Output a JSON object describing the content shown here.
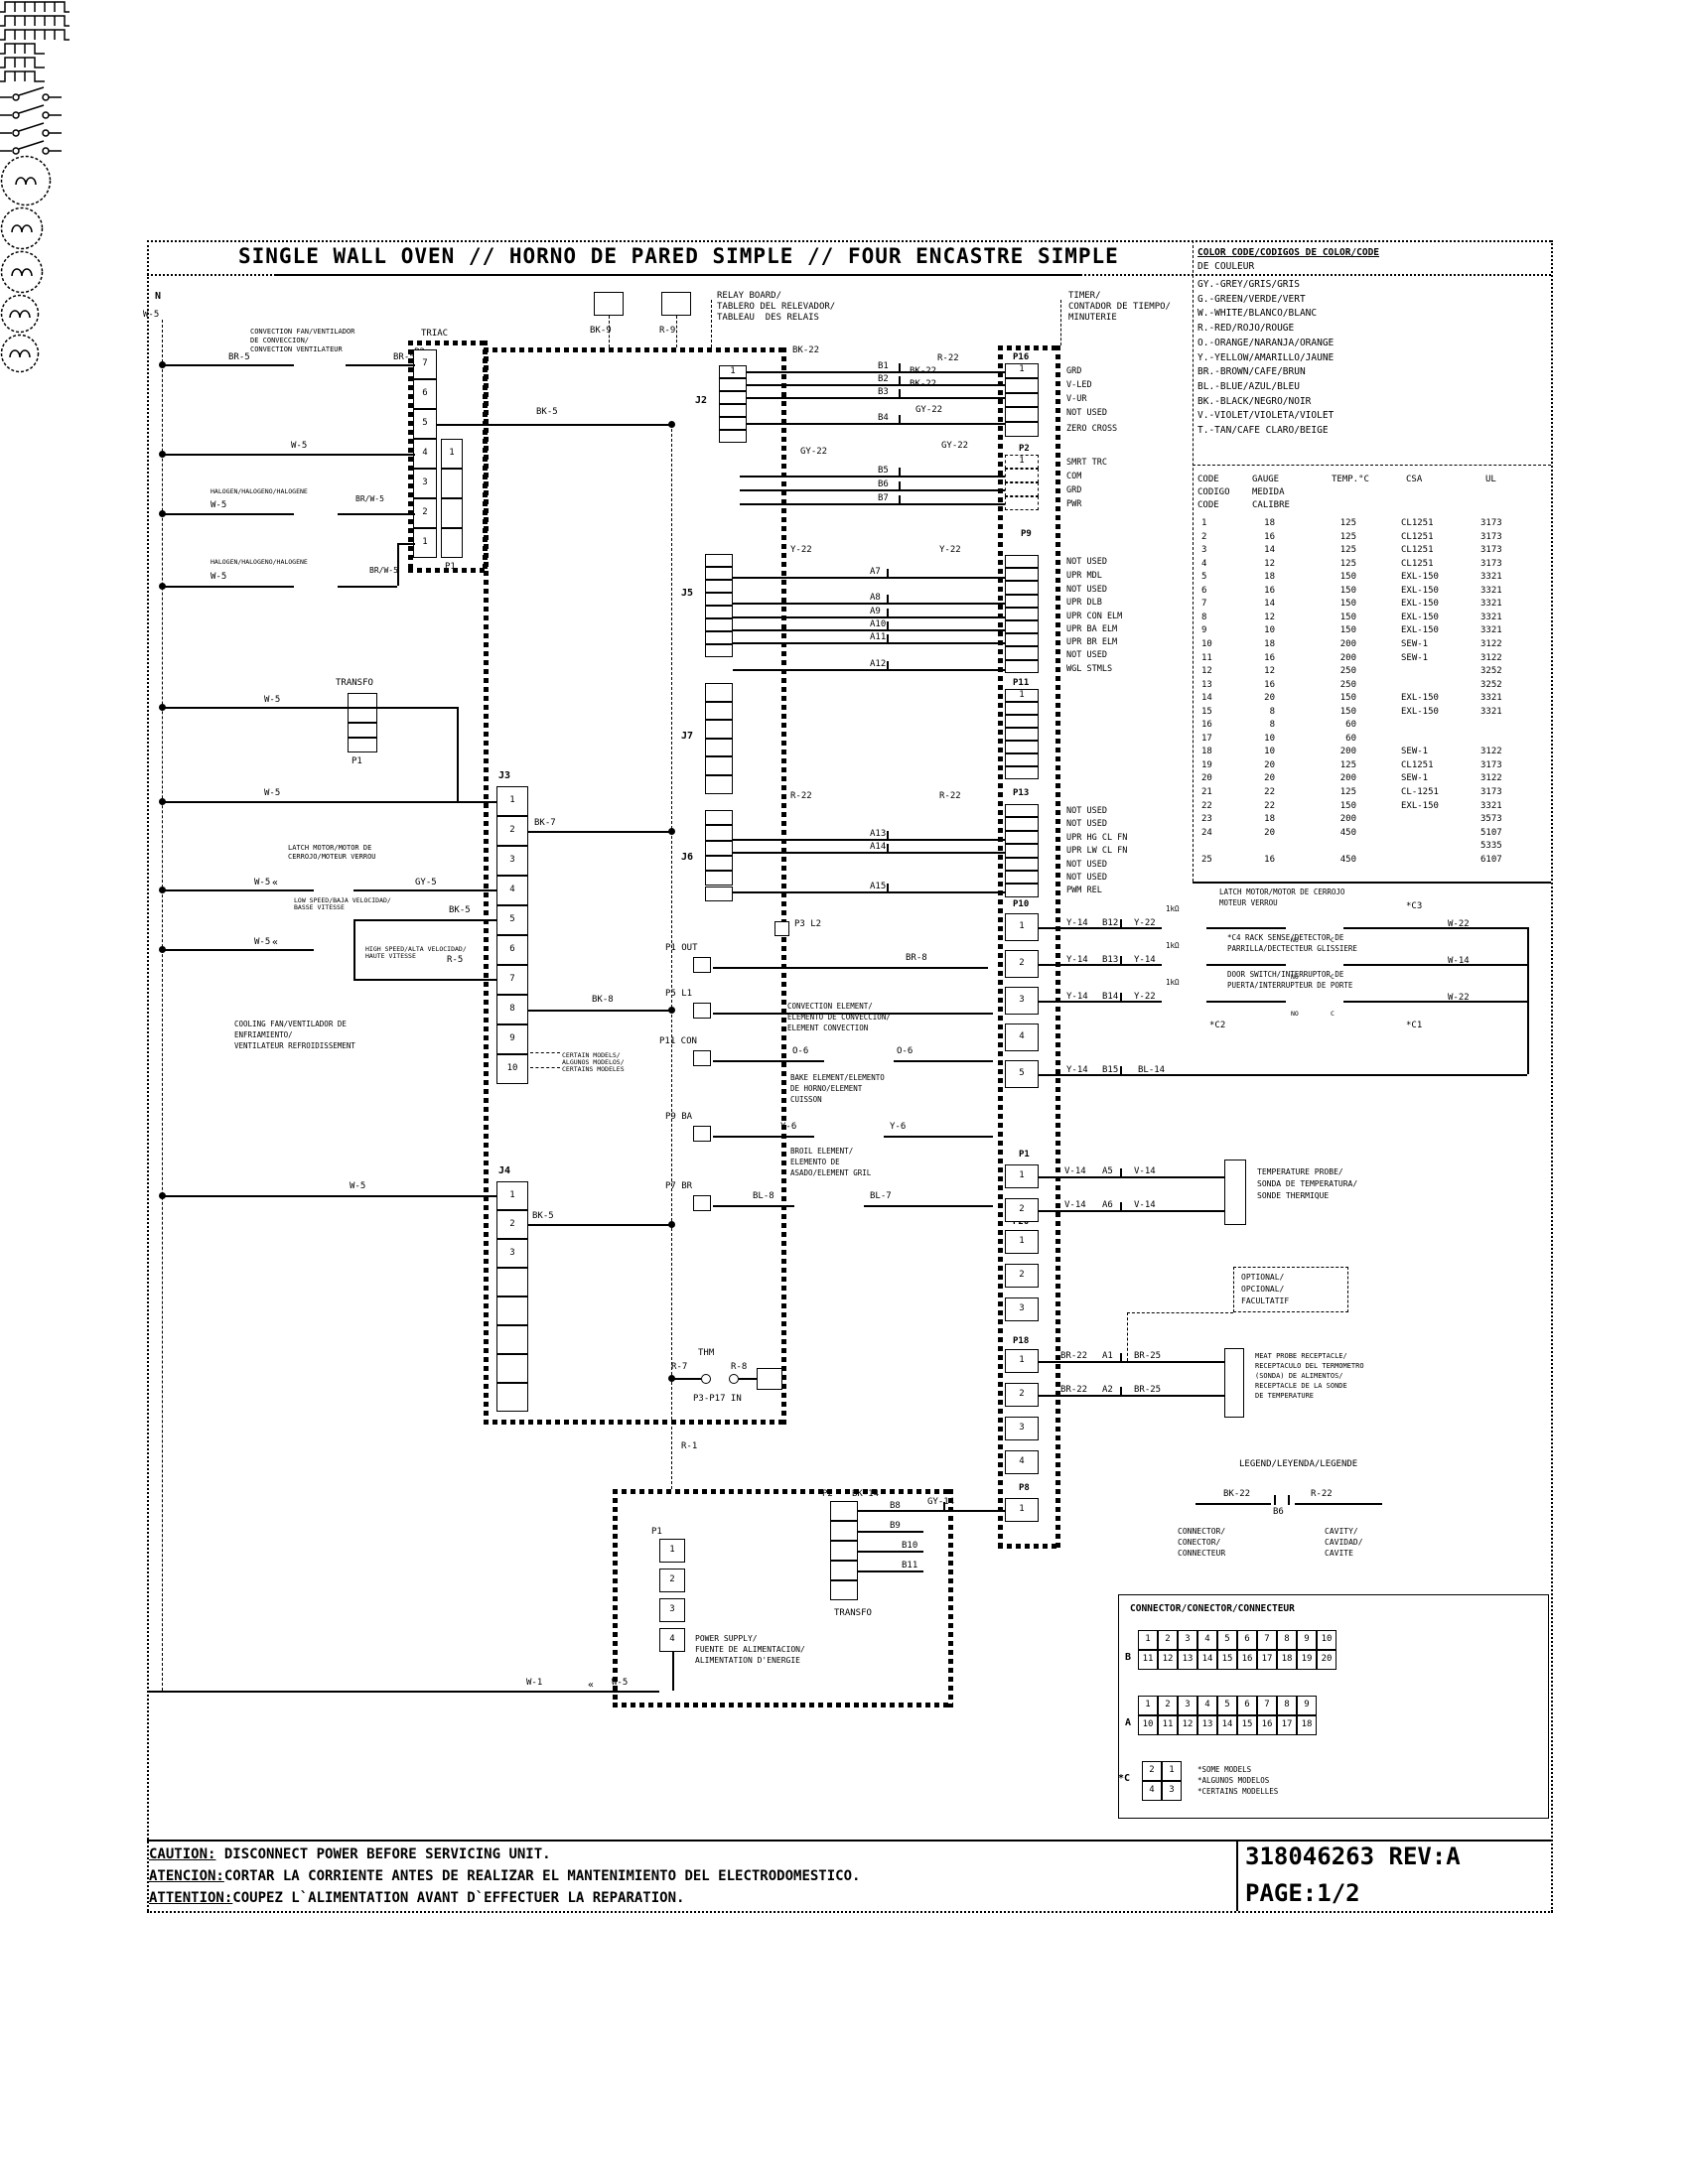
{
  "colors": {
    "ink": "#000000",
    "paper": "#ffffff"
  },
  "title": "SINGLE WALL OVEN // HORNO DE PARED SIMPLE // FOUR ENCASTRE SIMPLE",
  "caution": {
    "en_label": "CAUTION:",
    "en_text": " DISCONNECT POWER BEFORE SERVICING UNIT.",
    "es_label": "ATENCION:",
    "es_text": "CORTAR LA CORRIENTE ANTES DE REALIZAR EL MANTENIMIENTO DEL ELECTRODOMESTICO.",
    "fr_label": "ATTENTION:",
    "fr_text": "COUPEZ L`ALIMENTATION AVANT D`EFFECTUER LA REPARATION."
  },
  "footer": {
    "part_number": "318046263 REV:A",
    "page": "PAGE:1/2"
  },
  "color_code": {
    "title_l1": "COLOR CODE/CODIGOS DE COLOR/CODE",
    "title_l2": "DE COULEUR",
    "entries": [
      "GY.-GREY/GRIS/GRIS",
      "G.-GREEN/VERDE/VERT",
      "W.-WHITE/BLANCO/BLANC",
      "R.-RED/ROJO/ROUGE",
      "O.-ORANGE/NARANJA/ORANGE",
      "Y.-YELLOW/AMARILLO/JAUNE",
      "BR.-BROWN/CAFE/BRUN",
      "BL.-BLUE/AZUL/BLEU",
      "BK.-BLACK/NEGRO/NOIR",
      "V.-VIOLET/VIOLETA/VIOLET",
      "T.-TAN/CAFE CLARO/BEIGE"
    ]
  },
  "gauge_table": {
    "h1": [
      "CODE",
      "GAUGE",
      "TEMP.°C",
      "CSA",
      "UL"
    ],
    "h2": [
      "CODIGO",
      "MEDIDA"
    ],
    "h3": [
      "CODE",
      "CALIBRE"
    ],
    "rows": [
      [
        "1",
        "18",
        "125",
        "CL1251",
        "3173"
      ],
      [
        "2",
        "16",
        "125",
        "CL1251",
        "3173"
      ],
      [
        "3",
        "14",
        "125",
        "CL1251",
        "3173"
      ],
      [
        "4",
        "12",
        "125",
        "CL1251",
        "3173"
      ],
      [
        "5",
        "18",
        "150",
        "EXL-150",
        "3321"
      ],
      [
        "6",
        "16",
        "150",
        "EXL-150",
        "3321"
      ],
      [
        "7",
        "14",
        "150",
        "EXL-150",
        "3321"
      ],
      [
        "8",
        "12",
        "150",
        "EXL-150",
        "3321"
      ],
      [
        "9",
        "10",
        "150",
        "EXL-150",
        "3321"
      ],
      [
        "10",
        "18",
        "200",
        "SEW-1",
        "3122"
      ],
      [
        "11",
        "16",
        "200",
        "SEW-1",
        "3122"
      ],
      [
        "12",
        "12",
        "250",
        "",
        "3252"
      ],
      [
        "13",
        "16",
        "250",
        "",
        "3252"
      ],
      [
        "14",
        "20",
        "150",
        "EXL-150",
        "3321"
      ],
      [
        "15",
        "8",
        "150",
        "EXL-150",
        "3321"
      ],
      [
        "16",
        "8",
        "60",
        "",
        ""
      ],
      [
        "17",
        "10",
        "60",
        "",
        ""
      ],
      [
        "18",
        "10",
        "200",
        "SEW-1",
        "3122"
      ],
      [
        "19",
        "20",
        "125",
        "CL1251",
        "3173"
      ],
      [
        "20",
        "20",
        "200",
        "SEW-1",
        "3122"
      ],
      [
        "21",
        "22",
        "125",
        "CL-1251",
        "3173"
      ],
      [
        "22",
        "22",
        "150",
        "EXL-150",
        "3321"
      ],
      [
        "23",
        "18",
        "200",
        "",
        "3573"
      ],
      [
        "24",
        "20",
        "450",
        "",
        "5107"
      ],
      [
        "",
        "",
        "",
        "",
        "5335"
      ],
      [
        "25",
        "16",
        "450",
        "",
        "6107"
      ]
    ]
  },
  "timer_labels": {
    "p16": [
      "GRD",
      "V-LED",
      "V-UR",
      "NOT USED",
      "ZERO CROSS"
    ],
    "p2": [
      "SMRT TRC",
      "COM",
      "GRD",
      "PWR"
    ],
    "p9": [
      "NOT USED",
      "UPR MDL",
      "NOT USED",
      "UPR DLB",
      "UPR CON ELM",
      "UPR BA ELM",
      "UPR BR ELM",
      "NOT USED",
      "WGL STMLS"
    ],
    "p13": [
      "NOT USED",
      "NOT USED",
      "UPR HG CL FN",
      "UPR LW CL FN",
      "NOT USED",
      "NOT USED",
      "PWM REL"
    ]
  },
  "connectors": {
    "triac": [
      "7",
      "6",
      "5",
      "4",
      "3",
      "2",
      "1"
    ],
    "triac_inner": [
      "1",
      "",
      "",
      ""
    ],
    "transfo": [
      "",
      "",
      "",
      ""
    ],
    "j3": [
      "1",
      "2",
      "3",
      "4",
      "5",
      "6",
      "7",
      "8",
      "9",
      "10"
    ],
    "j4": [
      "1",
      "2",
      "3",
      "",
      "",
      "",
      "",
      ""
    ],
    "j2": [
      "1",
      "",
      "",
      "",
      "",
      ""
    ],
    "j5": [
      "",
      "",
      "",
      "",
      "",
      "",
      "",
      ""
    ],
    "j7": [
      "",
      "",
      "",
      "",
      "",
      ""
    ],
    "j6": [
      "",
      "",
      "",
      "",
      "",
      ""
    ],
    "p16": [
      "1",
      "",
      "",
      "",
      ""
    ],
    "p2": [
      "1",
      "",
      "",
      ""
    ],
    "p9": [
      "",
      "",
      "",
      "",
      "",
      "",
      "",
      "",
      ""
    ],
    "p11": [
      "1",
      "",
      "",
      "",
      "",
      "",
      ""
    ],
    "p13": [
      "",
      "",
      "",
      "",
      "",
      "",
      ""
    ],
    "p10": [
      "1",
      "2",
      "3",
      "4",
      "5"
    ],
    "p1": [
      "1",
      "2"
    ],
    "p20": [
      "1",
      "2",
      "3"
    ],
    "p18": [
      "1",
      "2",
      "3",
      "4"
    ],
    "p8": [
      "1"
    ],
    "ps_p1": [
      "1",
      "2",
      "3",
      "4"
    ],
    "ps_transfo": [
      "",
      "",
      "",
      "",
      ""
    ]
  },
  "connector_grid": {
    "title": "CONNECTOR/CONECTOR/CONNECTEUR",
    "b_label": "B",
    "a_label": "A",
    "c_label": "*C",
    "b_row1": [
      "1",
      "2",
      "3",
      "4",
      "5",
      "6",
      "7",
      "8",
      "9",
      "10"
    ],
    "b_row2": [
      "11",
      "12",
      "13",
      "14",
      "15",
      "16",
      "17",
      "18",
      "19",
      "20"
    ],
    "a_row1": [
      "1",
      "2",
      "3",
      "4",
      "5",
      "6",
      "7",
      "8",
      "9"
    ],
    "a_row2": [
      "10",
      "11",
      "12",
      "13",
      "14",
      "15",
      "16",
      "17",
      "18"
    ],
    "c_row1": [
      "2",
      "1"
    ],
    "c_row2": [
      "4",
      "3"
    ],
    "notes": [
      "*SOME MODELS",
      "*ALGUNOS MODELOS",
      "*CERTAINS MODELLES"
    ]
  },
  "labels": {
    "n": "N",
    "w5_top": "W-5",
    "convfan1": "CONVECTION FAN/VENTILADOR",
    "convfan2": "DE CONVECCION/",
    "convfan3": "CONVECTION VENTILATEUR",
    "br5_l": "BR-5",
    "br5_r": "BR-5",
    "triac": "TRIAC",
    "triac_p2": "P2",
    "triac_p1": "P1",
    "bk5_top": "BK-5",
    "w5_triac": "W-5",
    "hal1": "HALOGEN/HALOGENO/HALOGENE",
    "w5_hal1": "W-5",
    "brw5_1": "BR/W-5",
    "hal2": "HALOGEN/HALOGENO/HALOGENE",
    "w5_hal2": "W-5",
    "brw5_2": "BR/W-5",
    "transfo": "TRANSFO",
    "transfo_p1": "P1",
    "w5_transfo": "W-5",
    "j3": "J3",
    "w5_j3": "W-5",
    "bk7": "BK-7",
    "latch1": "LATCH MOTOR/MOTOR DE",
    "latch2": "CERROJO/MOTEUR VERROU",
    "w5_latch": "W-5",
    "gy5": "GY-5",
    "low1": "LOW SPEED/BAJA VELOCIDAD/",
    "low2": "BASSE VITESSE",
    "bk5_low": "BK-5",
    "w5_cool": "W-5",
    "r5": "R-5",
    "high1": "HIGH SPEED/ALTA VELOCIDAD/",
    "high2": "HAUTE VITESSE",
    "cool1": "COOLING FAN/VENTILADOR DE",
    "cool2": "ENFRIAMIENTO/",
    "cool3": "VENTILATEUR REFROIDISSEMENT",
    "bk8": "BK-8",
    "cert1": "CERTAIN MODELS/",
    "cert2": "ALGUNOS MODELOS/",
    "cert3": "CERTAINS MODELES",
    "j4": "J4",
    "w5_j4": "W-5",
    "bk5_j4": "BK-5",
    "l1": "L1",
    "l2": "L2",
    "bk9": "BK-9",
    "r9": "R-9",
    "relay1": "RELAY BOARD/",
    "relay2": "TABLERO DEL RELEVADOR/",
    "relay3": "TABLEAU  DES RELAIS",
    "j2": "J2",
    "j5": "J5",
    "j7": "J7",
    "j6": "J6",
    "bk22_l": "BK-22",
    "r22_b1": "R-22",
    "bk22_b2": "BK-22",
    "bk22_b3": "BK-22",
    "gy22_b4": "GY-22",
    "b1": "B1",
    "b2": "B2",
    "b3": "B3",
    "b4": "B4",
    "gy22_l": "GY-22",
    "gy22_r": "GY-22",
    "b5": "B5",
    "b6": "B6",
    "b7": "B7",
    "timer1": "TIMER/",
    "timer2": "CONTADOR DE TIEMPO/",
    "timer3": "MINUTERIE",
    "p16": "P16",
    "p2t": "P2",
    "p9": "P9",
    "p11": "P11",
    "p13": "P13",
    "p10": "P10",
    "p1t": "P1",
    "p20": "P20",
    "p18": "P18",
    "p8": "P8",
    "y22_l": "Y-22",
    "y22_r": "Y-22",
    "a7": "A7",
    "a8": "A8",
    "a9": "A9",
    "a10": "A10",
    "a11": "A11",
    "a12": "A12",
    "r22_l": "R-22",
    "r22_r": "R-22",
    "a13": "A13",
    "a14": "A14",
    "a15": "A15",
    "p3l2": "P3 L2",
    "p1out": "P1 OUT",
    "br8": "BR-8",
    "p5l1": "P5 L1",
    "conv1": "CONVECTION ELEMENT/",
    "conv2": "ELEMENTO DE CONVECCION/",
    "conv3": "ELEMENT CONVECTION",
    "p11con": "P11 CON",
    "o6a": "O-6",
    "o6b": "O-6",
    "bake1": "BAKE ELEMENT/ELEMENTO",
    "bake2": "DE HORNO/ELEMENT",
    "bake3": "CUISSON",
    "p9ba": "P9 BA",
    "y6a": "Y-6",
    "y6b": "Y-6",
    "broil1": "BROIL ELEMENT/",
    "broil2": "ELEMENTO DE",
    "broil3": "ASADO/ELEMENT GRIL",
    "p7br": "P7 BR",
    "bl8": "BL-8",
    "bl7": "BL-7",
    "thm": "THM",
    "r7": "R-7",
    "r8": "R-8",
    "p3p17": "P3-P17 IN",
    "r1": "R-1",
    "latchm1": "LATCH MOTOR/MOTOR DE CERROJO",
    "latchm2": "MOTEUR VERROU",
    "c3": "*C3",
    "w22_a": "W-22",
    "y14_b12": "Y-14",
    "b12": "B12",
    "y22_b12": "Y-22",
    "k1": "1kΩ",
    "y14_b13a": "Y-14",
    "b13": "B13",
    "y14_b13b": "Y-14",
    "k2": "1kΩ",
    "c4_1": "*C4 RACK SENSE/DETECTOR DE",
    "c4_2": "PARRILLA/DECTECTEUR GLISSIERE",
    "w14": "W-14",
    "y14_b14": "Y-14",
    "b14": "B14",
    "y22_b14": "Y-22",
    "k3": "1kΩ",
    "door1": "DOOR SWITCH/INTERRUPTOR DE",
    "door2": "PUERTA/INTERRUPTEUR DE PORTE",
    "w22_b": "W-22",
    "c2": "*C2",
    "c1": "*C1",
    "y14_b15": "Y-14",
    "b15": "B15",
    "bl14": "BL-14",
    "no1": "NO",
    "cc1": "C",
    "no2": "NO",
    "cc2": "C",
    "no3": "NO",
    "cc3": "C",
    "v14a": "V-14",
    "a5": "A5",
    "v14b": "V-14",
    "v14c": "V-14",
    "a6": "A6",
    "v14d": "V-14",
    "tprobe1": "TEMPERATURE PROBE/",
    "tprobe2": "SONDA DE TEMPERATURA/",
    "tprobe3": "SONDE THERMIQUE",
    "opt1": "OPTIONAL/",
    "opt2": "OPCIONAL/",
    "opt3": "FACULTATIF",
    "br22a": "BR-22",
    "a1": "A1",
    "br25a": "BR-25",
    "br22b": "BR-22",
    "a2": "A2",
    "br25b": "BR-25",
    "meat1": "MEAT PROBE RECEPTACLE/",
    "meat2": "RECEPTACULO DEL TERMOMETRO",
    "meat3": "(SONDA) DE ALIMENTOS/",
    "meat4": "RECEPTACLE DE LA SONDE",
    "meat5": "DE TEMPERATURE",
    "gy14": "GY-14",
    "ps_p1": "P1",
    "ps_p2": "P2",
    "bk14": "BK-14",
    "b8": "B8",
    "b9": "B9",
    "b10": "B10",
    "b11": "B11",
    "transfo2": "TRANSFO",
    "pow1": "POWER SUPPLY/",
    "pow2": "FUENTE DE ALIMENTACION/",
    "pow3": "ALIMENTATION D'ENERGIE",
    "w1": "W-1",
    "w5_ps": "W-5",
    "ch1": "«",
    "ch2": "«",
    "ch3": "«",
    "leg": "LEGEND/LEYENDA/LEGENDE",
    "bk22_leg": "BK-22",
    "r22_leg": "R-22",
    "b6_leg": "B6",
    "conn1": "CONNECTOR/",
    "conn2": "CONECTOR/",
    "conn3": "CONNECTEUR",
    "cav1": "CAVITY/",
    "cav2": "CAVIDAD/",
    "cav3": "CAVITE"
  }
}
